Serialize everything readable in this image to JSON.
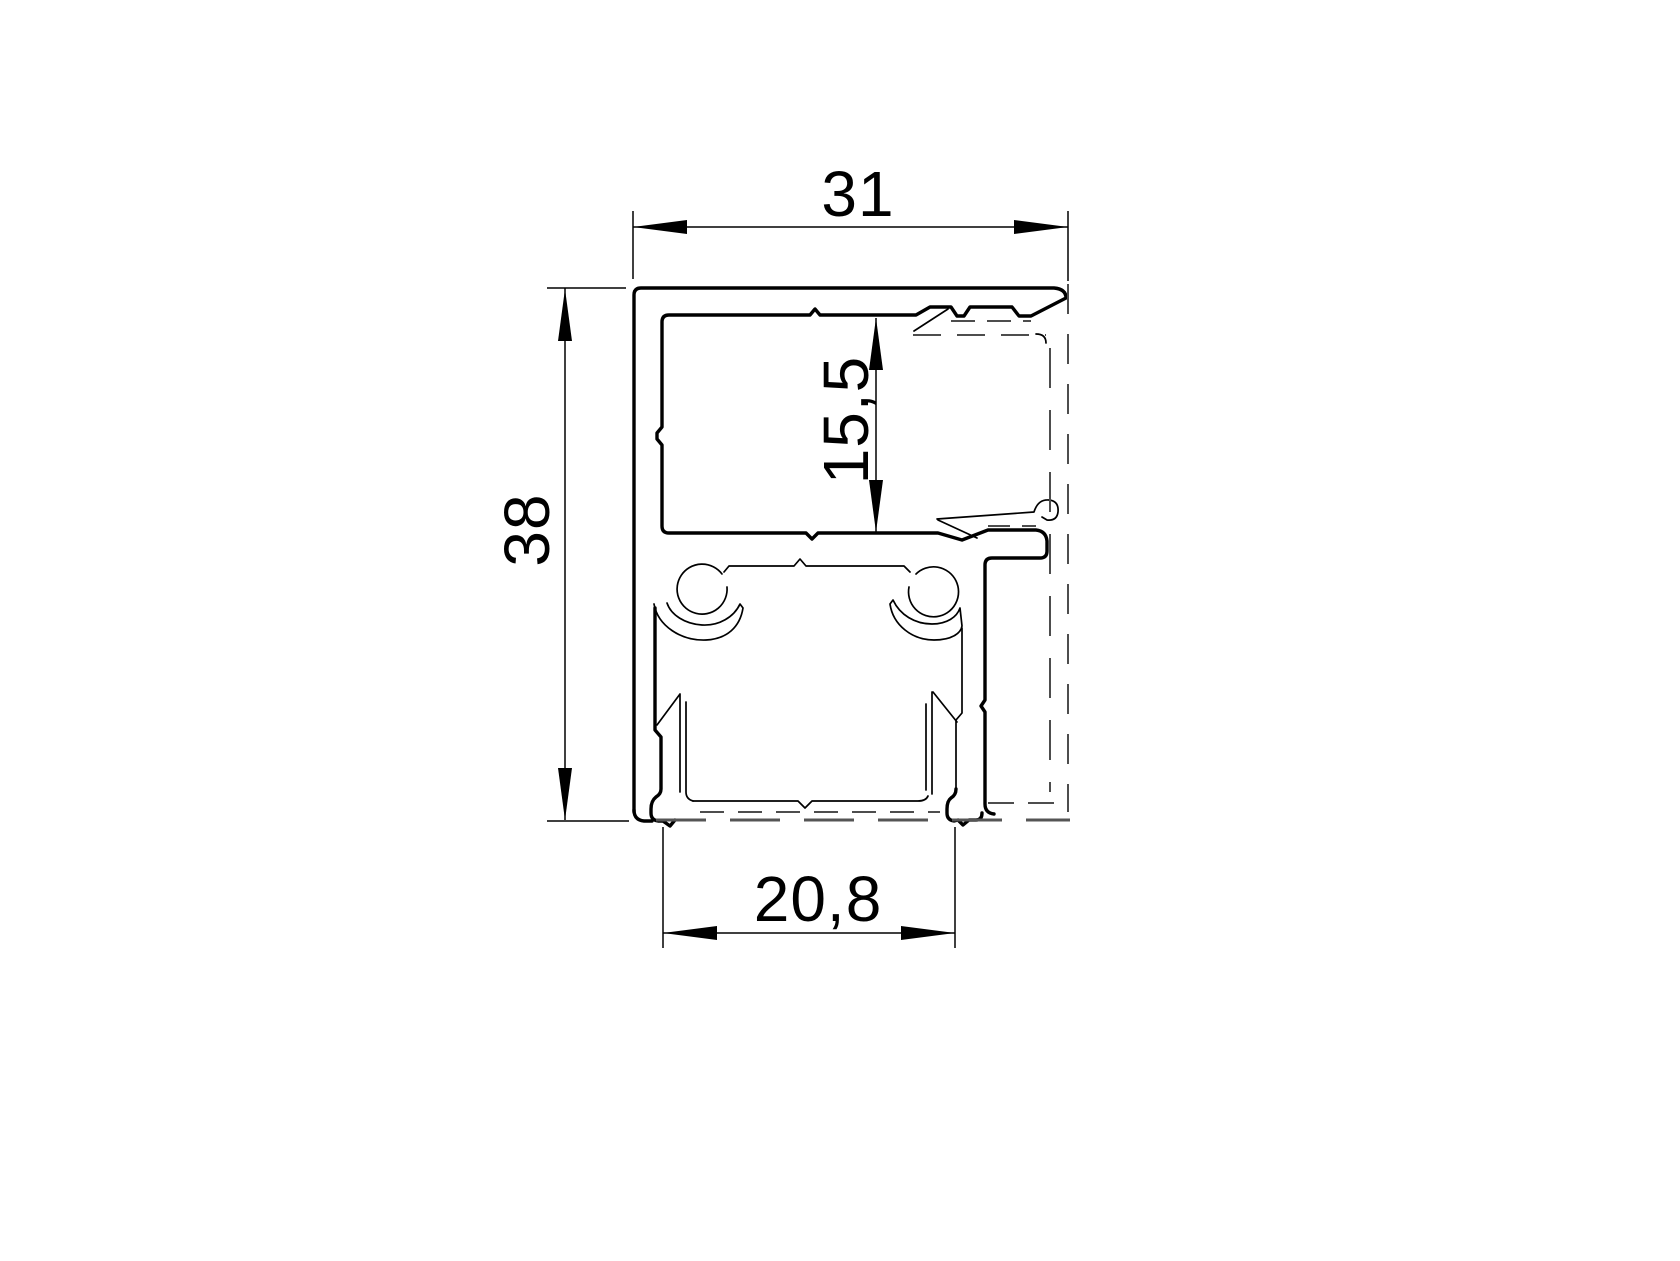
{
  "drawing": {
    "type": "technical-cross-section",
    "subject": "aluminium-extrusion-profile",
    "units_shown": "millimetres (implied, decimal comma)",
    "dimensions": {
      "top_width": "31",
      "left_height": "38",
      "inner_depth": "15,5",
      "bottom_channel_width": "20,8"
    },
    "colors": {
      "line": "#000000",
      "hidden_line": "#4d4d4d",
      "background": "#ffffff"
    },
    "line_styles": {
      "solid": "visible profile edges",
      "dashed": "hidden / phantom component edges"
    }
  }
}
